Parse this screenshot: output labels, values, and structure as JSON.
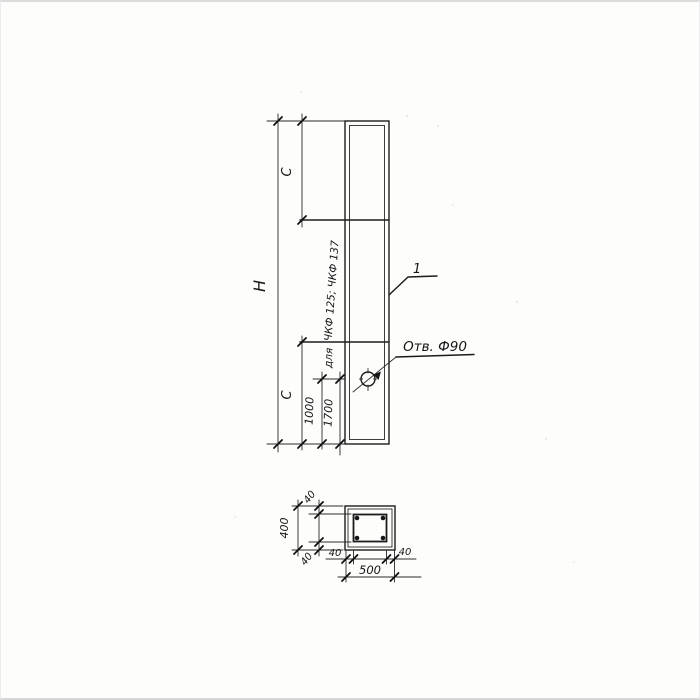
{
  "colors": {
    "background": "#fdfdfc",
    "ink": "#1c1c1c",
    "scan_edge": "#dcdcdc"
  },
  "elevation": {
    "labels": {
      "overall_height": "Н",
      "c_top": "С",
      "c_bottom": "С",
      "hole_offset_a": "1000",
      "hole_offset_b": "1700",
      "applicability_prefix": "для",
      "applicability_types": "ЧКФ 125; ЧКФ 137",
      "hole_callout": "Отв. Ф90",
      "item_number": "1"
    }
  },
  "section": {
    "labels": {
      "overall_width": "500",
      "overall_height": "400",
      "cover_top": "40",
      "cover_bottom": "40",
      "cover_left": "40",
      "cover_right": "40"
    }
  }
}
